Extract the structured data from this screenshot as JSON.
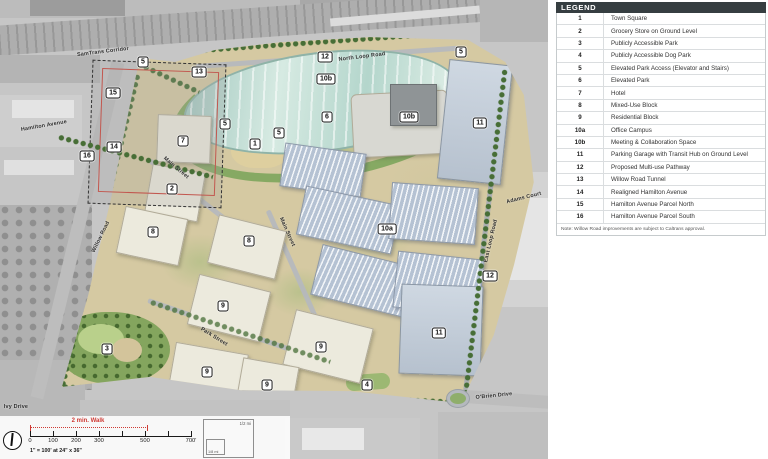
{
  "legend": {
    "title": "LEGEND",
    "items": [
      {
        "key": "1",
        "label": "Town Square"
      },
      {
        "key": "2",
        "label": "Grocery Store on Ground Level"
      },
      {
        "key": "3",
        "label": "Publicly Accessible Park"
      },
      {
        "key": "4",
        "label": "Publicly Accessible Dog Park"
      },
      {
        "key": "5",
        "label": "Elevated Park Access (Elevator and Stairs)"
      },
      {
        "key": "6",
        "label": "Elevated Park"
      },
      {
        "key": "7",
        "label": "Hotel"
      },
      {
        "key": "8",
        "label": "Mixed-Use Block"
      },
      {
        "key": "9",
        "label": "Residential Block"
      },
      {
        "key": "10a",
        "label": "Office Campus"
      },
      {
        "key": "10b",
        "label": "Meeting & Collaboration Space"
      },
      {
        "key": "11",
        "label": "Parking Garage with Transit Hub on Ground Level"
      },
      {
        "key": "12",
        "label": "Proposed Multi-use Pathway"
      },
      {
        "key": "13",
        "label": "Willow Road Tunnel"
      },
      {
        "key": "14",
        "label": "Realigned Hamilton Avenue"
      },
      {
        "key": "15",
        "label": "Hamilton Avenue Parcel North"
      },
      {
        "key": "16",
        "label": "Hamilton Avenue Parcel South"
      }
    ],
    "note": "Note: Willow Road improvements are subject to Caltrans approval."
  },
  "map": {
    "markers": [
      {
        "n": "5",
        "x": 143,
        "y": 62
      },
      {
        "n": "13",
        "x": 199,
        "y": 72
      },
      {
        "n": "15",
        "x": 113,
        "y": 93
      },
      {
        "n": "14",
        "x": 114,
        "y": 147
      },
      {
        "n": "16",
        "x": 87,
        "y": 156
      },
      {
        "n": "12",
        "x": 325,
        "y": 57
      },
      {
        "n": "10b",
        "x": 326,
        "y": 79
      },
      {
        "n": "5",
        "x": 461,
        "y": 52
      },
      {
        "n": "6",
        "x": 327,
        "y": 117
      },
      {
        "n": "5",
        "x": 279,
        "y": 133
      },
      {
        "n": "5",
        "x": 225,
        "y": 124
      },
      {
        "n": "7",
        "x": 183,
        "y": 141
      },
      {
        "n": "1",
        "x": 255,
        "y": 144
      },
      {
        "n": "10b",
        "x": 409,
        "y": 117
      },
      {
        "n": "11",
        "x": 480,
        "y": 123
      },
      {
        "n": "2",
        "x": 172,
        "y": 189
      },
      {
        "n": "8",
        "x": 153,
        "y": 232
      },
      {
        "n": "8",
        "x": 249,
        "y": 241
      },
      {
        "n": "10a",
        "x": 387,
        "y": 229
      },
      {
        "n": "12",
        "x": 490,
        "y": 276
      },
      {
        "n": "9",
        "x": 223,
        "y": 306
      },
      {
        "n": "9",
        "x": 321,
        "y": 347
      },
      {
        "n": "9",
        "x": 207,
        "y": 372
      },
      {
        "n": "9",
        "x": 267,
        "y": 385
      },
      {
        "n": "3",
        "x": 107,
        "y": 349
      },
      {
        "n": "4",
        "x": 367,
        "y": 385
      },
      {
        "n": "11",
        "x": 439,
        "y": 333
      }
    ],
    "road_labels": [
      {
        "text": "SamTrans Corridor",
        "x": 103,
        "y": 52,
        "rot": -7
      },
      {
        "text": "Hamilton Avenue",
        "x": 44,
        "y": 126,
        "rot": -10
      },
      {
        "text": "Willow Road",
        "x": 101,
        "y": 237,
        "rot": -64
      },
      {
        "text": "Ivy Drive",
        "x": 16,
        "y": 407,
        "rot": 0
      },
      {
        "text": "Main Street",
        "x": 176,
        "y": 168,
        "rot": 40
      },
      {
        "text": "Main Street",
        "x": 287,
        "y": 232,
        "rot": 66
      },
      {
        "text": "North Loop Road",
        "x": 362,
        "y": 57,
        "rot": -7
      },
      {
        "text": "Adams Court",
        "x": 524,
        "y": 198,
        "rot": -14
      },
      {
        "text": "East Loop Road",
        "x": 491,
        "y": 241,
        "rot": -77
      },
      {
        "text": "O'Brien Drive",
        "x": 494,
        "y": 396,
        "rot": -6
      },
      {
        "text": "Park Street",
        "x": 214,
        "y": 337,
        "rot": 32
      }
    ]
  },
  "scalebar": {
    "walk_label": "2 min. Walk",
    "ticks": [
      {
        "t": "0",
        "o": 0
      },
      {
        "t": "100",
        "o": 23
      },
      {
        "t": "200",
        "o": 46
      },
      {
        "t": "300",
        "o": 69
      },
      {
        "t": "500",
        "o": 115
      },
      {
        "t": "700'",
        "o": 161
      }
    ],
    "caption": "1\" = 100'  at 24\" x 36\"",
    "inset_outer": "1/2 mi",
    "inset_inner": "1/8 mi"
  },
  "colors": {
    "legend_header": "#363e41",
    "site_tan": "#d5c9a2",
    "park_green": "#84a55e",
    "tree_green": "#476e36",
    "office_roof": "#b5c2d3",
    "garage_roof": "#c3cdd8",
    "lake_glass": "#b4d6cc",
    "walk_red": "#cf3a34",
    "boundary_red": "#c2574f"
  }
}
